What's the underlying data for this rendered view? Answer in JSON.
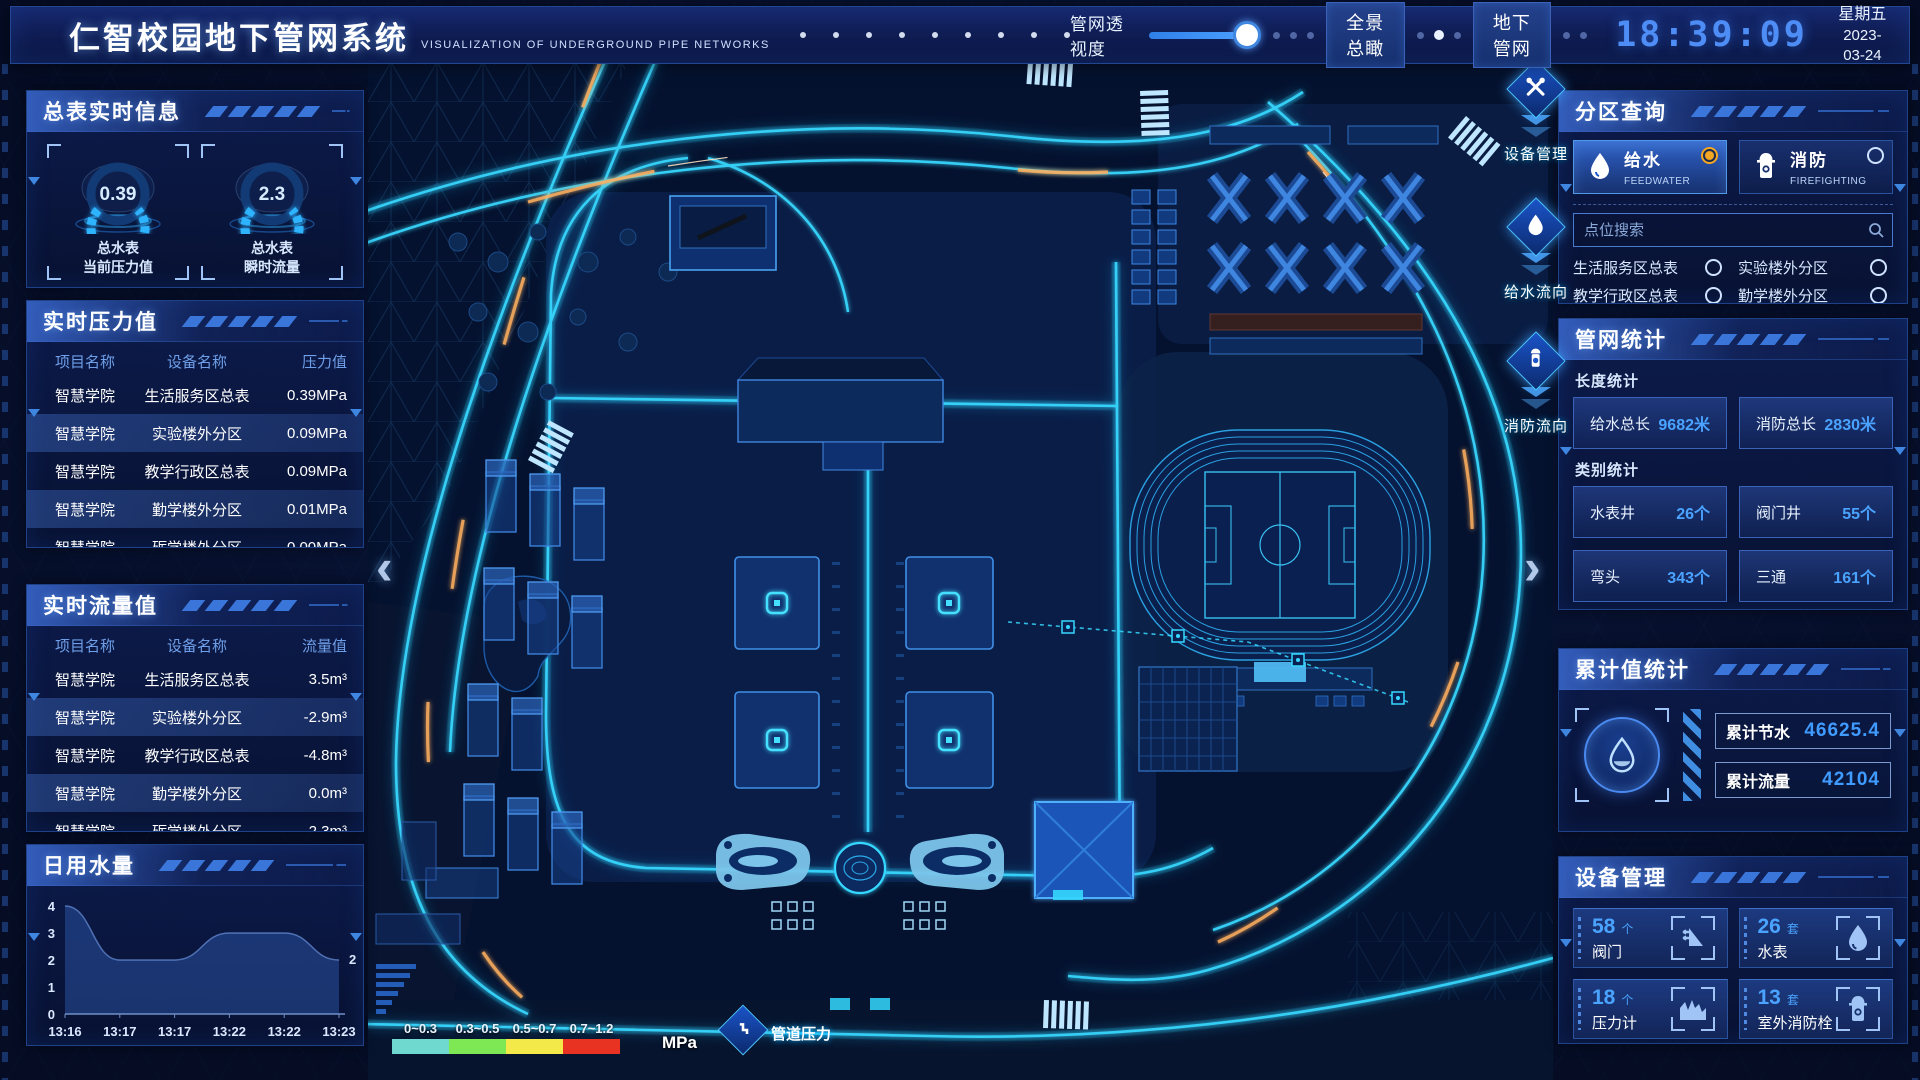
{
  "header": {
    "title": "仁智校园地下管网系统",
    "subtitle": "VISUALIZATION OF UNDERGROUND PIPE NETWORKS",
    "transparency_label": "管网透视度",
    "slider_percent": 88,
    "btn_overview": "全景总瞰",
    "btn_underground": "地下管网",
    "time": "18:39:09",
    "weekday": "星期五",
    "date": "2023-03-24"
  },
  "left": {
    "realtime_info": {
      "title": "总表实时信息",
      "gauges": [
        {
          "value": "0.39",
          "label1": "总水表",
          "label2": "当前压力值"
        },
        {
          "value": "2.3",
          "label1": "总水表",
          "label2": "瞬时流量"
        }
      ]
    },
    "pressure": {
      "title": "实时压力值",
      "columns": [
        "项目名称",
        "设备名称",
        "压力值"
      ],
      "rows": [
        [
          "智慧学院",
          "生活服务区总表",
          "0.39MPa"
        ],
        [
          "智慧学院",
          "实验楼外分区",
          "0.09MPa"
        ],
        [
          "智慧学院",
          "教学行政区总表",
          "0.09MPa"
        ],
        [
          "智慧学院",
          "勤学楼外分区",
          "0.01MPa"
        ],
        [
          "智慧学院",
          "砺学楼外分区",
          "0.00MPa"
        ]
      ]
    },
    "flow": {
      "title": "实时流量值",
      "columns": [
        "项目名称",
        "设备名称",
        "流量值"
      ],
      "rows": [
        [
          "智慧学院",
          "生活服务区总表",
          "3.5m³"
        ],
        [
          "智慧学院",
          "实验楼外分区",
          "-2.9m³"
        ],
        [
          "智慧学院",
          "教学行政区总表",
          "-4.8m³"
        ],
        [
          "智慧学院",
          "勤学楼外分区",
          "0.0m³"
        ],
        [
          "智慧学院",
          "砺学楼外分区",
          "-2.3m³"
        ]
      ]
    },
    "daily_water": {
      "title": "日用水量"
    }
  },
  "chart_data": {
    "type": "area",
    "title": "日用水量",
    "x": [
      "13:16",
      "13:17",
      "13:17",
      "13:22",
      "13:22",
      "13:23"
    ],
    "values": [
      4,
      2,
      2,
      3,
      3,
      2
    ],
    "ylim": [
      0,
      4
    ],
    "yticks": [
      0,
      1,
      2,
      3,
      4
    ],
    "end_label": "2",
    "end_label_color": "#e8c94a",
    "grid": false,
    "legend": "none"
  },
  "map": {
    "tools": [
      {
        "label": "设备管理",
        "icon": "wrench-icon"
      },
      {
        "label": "给水流向",
        "icon": "droplet-icon"
      },
      {
        "label": "消防流向",
        "icon": "hydrant-icon"
      }
    ],
    "legend": {
      "ranges": [
        {
          "label": "0~0.3",
          "color": "#6fd8cf"
        },
        {
          "label": "0.3~0.5",
          "color": "#7ee854"
        },
        {
          "label": "0.5~0.7",
          "color": "#f3e948"
        },
        {
          "label": "0.7~1.2",
          "color": "#e83323"
        }
      ],
      "unit": "MPa",
      "pressure_label": "管道压力"
    }
  },
  "right": {
    "zone_query": {
      "title": "分区查询",
      "tabs": [
        {
          "label": "给水",
          "sub": "FEEDWATER",
          "selected": true
        },
        {
          "label": "消防",
          "sub": "FIREFIGHTING",
          "selected": false
        }
      ],
      "search_placeholder": "点位搜索",
      "items": [
        "生活服务区总表",
        "实验楼外分区",
        "教学行政区总表",
        "勤学楼外分区",
        "砺学楼外分区",
        "宿舍区泵房"
      ]
    },
    "pipe_stats": {
      "title": "管网统计",
      "length_label": "长度统计",
      "length_stats": [
        {
          "label": "给水总长",
          "value": "9682米"
        },
        {
          "label": "消防总长",
          "value": "2830米"
        }
      ],
      "category_label": "类别统计",
      "category_stats": [
        {
          "label": "水表井",
          "value": "26个"
        },
        {
          "label": "阀门井",
          "value": "55个"
        },
        {
          "label": "弯头",
          "value": "343个"
        },
        {
          "label": "三通",
          "value": "161个"
        }
      ]
    },
    "cumulative": {
      "title": "累计值统计",
      "stats": [
        {
          "label": "累计节水",
          "value": "46625.4"
        },
        {
          "label": "累计流量",
          "value": "42104"
        }
      ]
    },
    "devices": {
      "title": "设备管理",
      "cards": [
        {
          "count": "58",
          "unit": "个",
          "label": "阀门",
          "icon": "valve-icon"
        },
        {
          "count": "26",
          "unit": "套",
          "label": "水表",
          "icon": "water-meter-icon"
        },
        {
          "count": "18",
          "unit": "个",
          "label": "压力计",
          "icon": "pressure-gauge-icon"
        },
        {
          "count": "13",
          "unit": "套",
          "label": "室外消防栓",
          "icon": "outdoor-hydrant-icon"
        }
      ]
    }
  }
}
